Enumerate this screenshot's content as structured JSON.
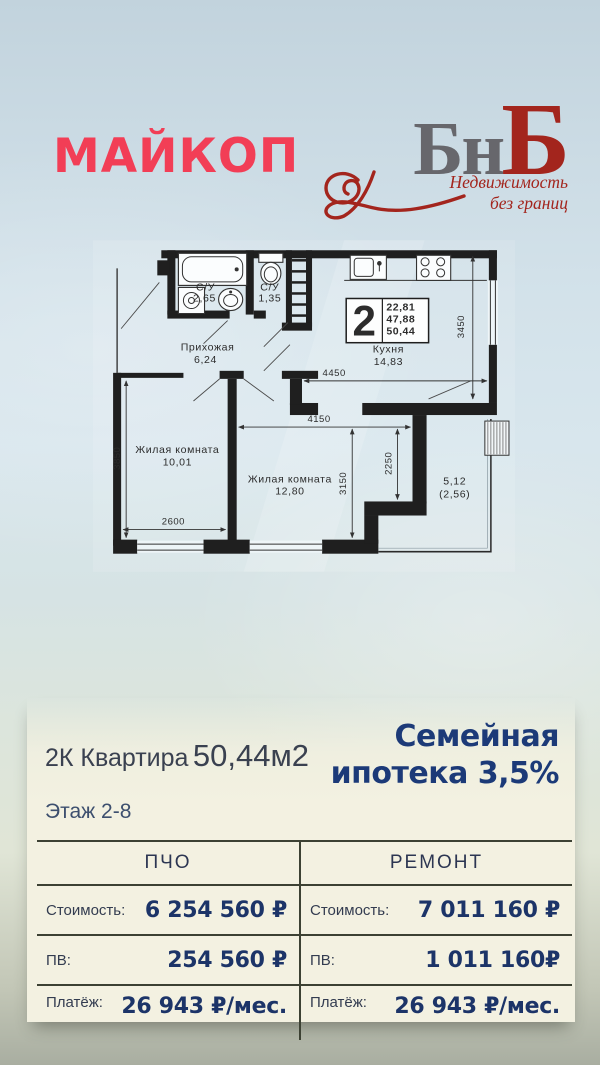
{
  "header": {
    "city": "МАЙКОП",
    "logo": {
      "gray_letters": "Бн",
      "red_letter": "Б",
      "tagline_line1": "Недвижимость",
      "tagline_line2": "без границ"
    }
  },
  "plan": {
    "unit_badge": {
      "number": "2",
      "area_lines": [
        "22,81",
        "47,88",
        "50,44"
      ]
    },
    "rooms": {
      "bath_main": {
        "name": "С/У",
        "area": "2,65"
      },
      "bath_small": {
        "name": "С/У",
        "area": "1,35"
      },
      "hallway": {
        "name": "Прихожая",
        "area": "6,24"
      },
      "kitchen": {
        "name": "Кухня",
        "area": "14,83"
      },
      "living1": {
        "name": "Жилая комната",
        "area": "10,01"
      },
      "living2": {
        "name": "Жилая комната",
        "area": "12,80"
      },
      "balcony": {
        "area": "5,12",
        "area_coeff": "(2,56)"
      }
    },
    "dimensions": {
      "kitchen_height": "3450",
      "kitchen_width": "4450",
      "living2_width": "4150",
      "living2_height": "3150",
      "niche_height": "2250",
      "living1_height": "3850",
      "living1_width": "2600"
    }
  },
  "offer": {
    "apartment_type": "2К Квартира",
    "apartment_area": "50,44м2",
    "promo_line1": "Семейная",
    "promo_line2": "ипотека 3,5%",
    "floors": "Этаж 2-8"
  },
  "price_table": {
    "columns": [
      {
        "header": "ПЧО",
        "rows": [
          {
            "label": "Стоимость:",
            "value": "6 254 560 ₽"
          },
          {
            "label": "ПВ:",
            "value": "254 560 ₽"
          },
          {
            "label": "Платёж:",
            "value": "26 943 ₽/мес."
          }
        ]
      },
      {
        "header": "РЕМОНТ",
        "rows": [
          {
            "label": "Стоимость:",
            "value": "7 011 160 ₽"
          },
          {
            "label": "ПВ:",
            "value": "1 011 160₽"
          },
          {
            "label": "Платёж:",
            "value": "26 943 ₽/мес."
          }
        ]
      }
    ]
  },
  "colors": {
    "accent_red": "#f23e56",
    "logo_red": "#a3251d",
    "logo_gray": "#67676c",
    "navy": "#1c3a78",
    "panel_cream": "#f3f1e1"
  }
}
